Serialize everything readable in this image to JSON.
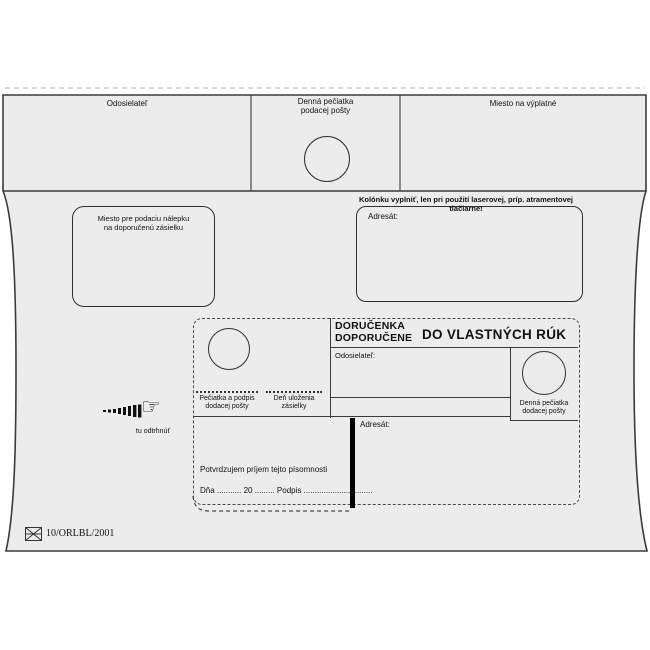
{
  "colors": {
    "envelope_fill": "#ececec",
    "line_color": "#3b3b3b",
    "text_color": "#111111"
  },
  "envelope": {
    "flap": {
      "sender_label": "Odosielateľ",
      "posting_stamp_label_line1": "Denná pečiatka",
      "posting_stamp_label_line2": "podacej pošty",
      "postage_label": "Miesto na výplatné"
    },
    "body": {
      "registered_label_box_line1": "Miesto pre podaciu nálepku",
      "registered_label_box_line2": "na doporučenú zásielku",
      "printer_note": "Kolónku vyplniť, len pri použití laserovej, príp. atramentovej tlačiarne!",
      "addressee_label": "Adresát:"
    },
    "delivery_card": {
      "title_line1": "DORUČENKA",
      "title_line2": "DOPORUČENE",
      "title_right": "DO VLASTNÝCH RÚK",
      "sender_label": "Odosielateľ:",
      "addressee_label": "Adresát:",
      "delivery_stamp_signature_line1": "Pečiatka a podpis",
      "delivery_stamp_signature_line2": "dodacej pošty",
      "storage_day_line1": "Deň uloženia",
      "storage_day_line2": "zásielky",
      "delivery_daily_stamp_line1": "Denná pečiatka",
      "delivery_daily_stamp_line2": "dodacej pošty",
      "confirmation_text": "Potvrdzujem príjem tejto písomnosti",
      "date_signature_line": "Dňa ........... 20 ......... Podpis ..............................."
    },
    "tear_here_label": "tu odtrhnúť",
    "form_code": "10/ORLBL/2001"
  }
}
